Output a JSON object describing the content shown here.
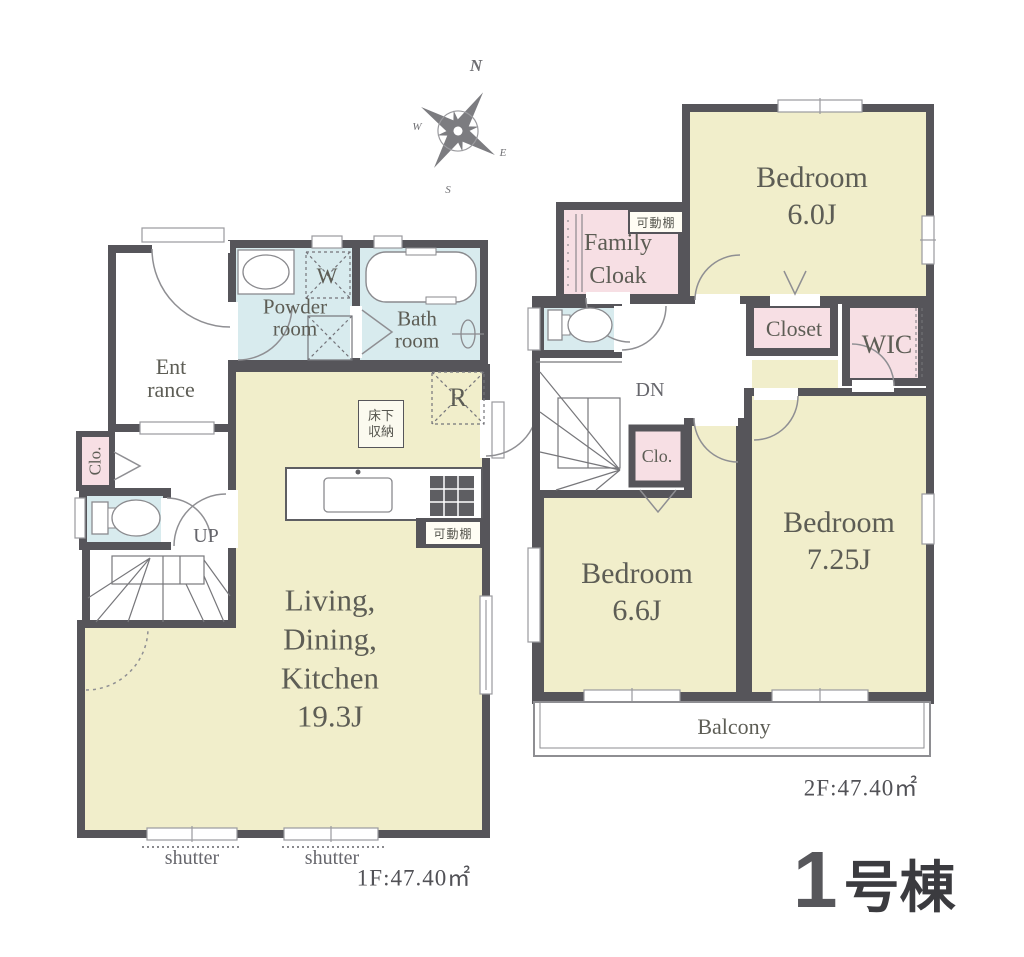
{
  "compass": {
    "north": "N",
    "west": "W",
    "east": "E",
    "south": "S"
  },
  "floor1": {
    "powder_room": [
      "Powder",
      "room"
    ],
    "bath_room": [
      "Bath",
      "room"
    ],
    "entrance": [
      "Ent",
      "rance"
    ],
    "closet": "Clo.",
    "stairs": "UP",
    "ldk": [
      "Living,",
      "Dining,",
      "Kitchen",
      "19.3J"
    ],
    "washer": "W",
    "refrigerator": "R",
    "underfloor_storage": [
      "床下",
      "収納"
    ],
    "movable_shelf": "可動棚",
    "shutter_left": "shutter",
    "shutter_right": "shutter",
    "area": "1F:47.40㎡"
  },
  "floor2": {
    "bedroom_60": [
      "Bedroom",
      "6.0J"
    ],
    "family_cloak": [
      "Family",
      "Cloak"
    ],
    "movable_shelf": "可動棚",
    "closet": "Closet",
    "wic": "WIC",
    "stairs": "DN",
    "clo": "Clo.",
    "bedroom_66": [
      "Bedroom",
      "6.6J"
    ],
    "bedroom_725": [
      "Bedroom",
      "7.25J"
    ],
    "balcony": "Balcony",
    "area": "2F:47.40㎡"
  },
  "building": {
    "number": "1",
    "suffix": "号棟"
  },
  "colors": {
    "wall": "#56555a",
    "room_yellow": "#f1eecb",
    "room_pink": "#f7dfe4",
    "room_blue": "#d8ebee",
    "label_text": "#5d5d55"
  }
}
